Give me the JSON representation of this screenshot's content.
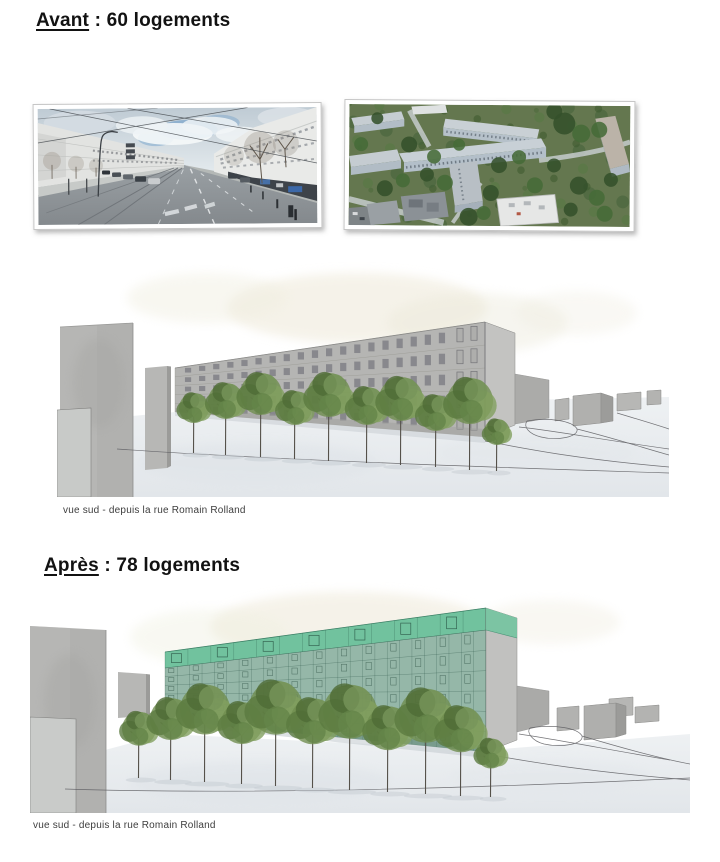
{
  "document": {
    "sections": [
      {
        "id": "before",
        "title_keyword": "Avant",
        "title_rest": " : 60 logements",
        "units": 60,
        "caption": "vue sud - depuis la rue Romain Rolland"
      },
      {
        "id": "after",
        "title_keyword": "Après",
        "title_rest": " : 78 logements",
        "units": 78,
        "caption": "vue sud - depuis la rue Romain Rolland"
      }
    ]
  },
  "colors": {
    "heading_text": "#121212",
    "caption_text": "#3d3d3d",
    "facade_green": "#6fc29d",
    "sketch_gray": "#b2b2b0",
    "page_background": "#ffffff"
  }
}
